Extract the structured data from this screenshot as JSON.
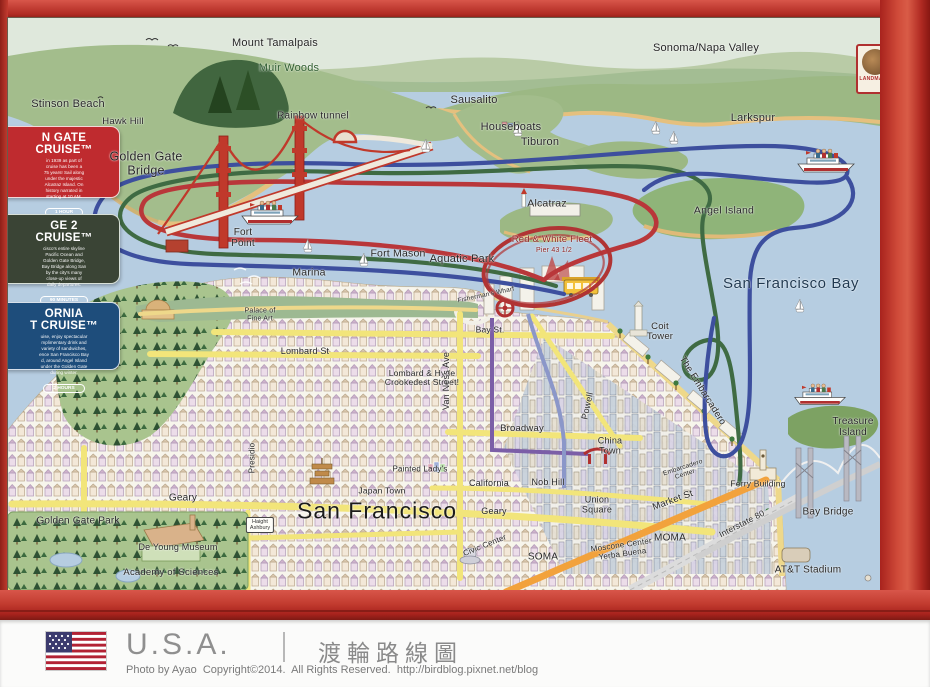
{
  "badge": {
    "text": "LANDMARK"
  },
  "colors": {
    "frame_red": "#bc2f2a",
    "water": "#b6cde1",
    "street_yellow": "#f2e57a",
    "market_orange": "#f2a23c",
    "route_red": "#b9373a",
    "route_green": "#3f6b43",
    "route_blue": "#3d4f9e",
    "annotation_circle": "#b03434"
  },
  "sidebar": {
    "cruises": [
      {
        "title_line1": "N GATE",
        "title_line2": "CRUISE™",
        "body": "in 1939 as part of\ncruise has been a\n75 years! Sail along\nunder the majestic\nAlcatraz Island. On\nhistory narrated in\nstarting at 10 AM.",
        "duration": "1 HOUR",
        "color": "#bf2b2f"
      },
      {
        "title_line1": "GE 2",
        "title_line2": "CRUISE™",
        "body": "cisco's entire skyline\nPacific Ocean and\nGolden Gate Bridge,\nBay Bridge along San\nby the city's many\nclose-up views of\ndaily departures.",
        "duration": "90 MINUTES",
        "color": "#3a4435"
      },
      {
        "title_line1": "ORNIA",
        "title_line2": "T CRUISE™",
        "body": "uise, enjoy spectacular\nmplimentary drink and\nvariety of sandwiches,\nence San Francisco Bay\nd, around Angel Island\nunder the Golden Gate\nduring winter.",
        "duration": "2 HOURS",
        "color": "#1e4d7b"
      }
    ]
  },
  "labels": {
    "mount_tamalpais": "Mount Tamalpais",
    "muir_woods": "Muir Woods",
    "sonoma_napa_valley": "Sonoma/Napa Valley",
    "stinson_beach": "Stinson Beach",
    "hawk_hill": "Hawk Hill",
    "rainbow_tunnel": "Rainbow tunnel",
    "sausalito": "Sausalito",
    "houseboats": "Houseboats",
    "tiburon": "Tiburon",
    "larkspur": "Larkspur",
    "golden_gate_bridge_1": "Golden Gate",
    "golden_gate_bridge_2": "Bridge",
    "fort_point_1": "Fort",
    "fort_point_2": "Point",
    "marina": "Marina",
    "fort_mason": "Fort Mason",
    "aquatic_park": "Aquatic Park",
    "alcatraz": "Alcatraz",
    "angel_island": "Angel Island",
    "red_white_fleet": "Red & White Fleet",
    "pier_43": "Pier 43 1/2",
    "san_francisco_bay": "San Francisco Bay",
    "fishermans_wharf": "Fisherman's Wharf",
    "coit_tower_1": "Coit",
    "coit_tower_2": "Tower",
    "bay_st": "Bay St.",
    "lombard_st": "Lombard St",
    "crookedest_1": "Lombard & Hyde",
    "crookedest_2": "Crookedest Street!",
    "van_ness_ave": "Van Ness Ave",
    "powell": "Powell",
    "broadway": "Broadway",
    "china_town_1": "China",
    "china_town_2": "Town",
    "the_embarcadero": "The Embarcadero",
    "treasure_island_1": "Treasure",
    "treasure_island_2": "Island",
    "nob_hill": "Nob Hill",
    "union_square_1": "Union",
    "union_square_2": "Square",
    "market_st": "Market St",
    "california_st": "California",
    "geary_downtown": "Geary",
    "japan_town": "Japan Town",
    "painted_ladys": "Painted Lady's",
    "san_francisco": "San Francisco",
    "geary_richmond": "Geary",
    "golden_gate_park": "Golden Gate Park",
    "de_young_museum": "De Young Museum",
    "academy_of_sciences": "Academy of Sciences",
    "haight_1": "Haight",
    "haight_2": "Ashbury",
    "presidio": "Presidio",
    "palace_1": "Palace of",
    "palace_2": "Fine Art",
    "soma": "SOMA",
    "moscone_1": "Moscone Center",
    "moscone_2": "Yerba Buena",
    "moma": "MOMA",
    "interstate_80": "Interstate 80",
    "civic_center": "Civic Center",
    "ferry_building": "Ferry Building",
    "bay_bridge": "Bay Bridge",
    "att_stadium": "AT&T Stadium",
    "embarcadero_center_1": "Embarcadero",
    "embarcadero_center_2": "Center"
  },
  "caption": {
    "country": "U.S.A.",
    "title_zh": "渡輪路線圖",
    "credit": "Photo by Ayao  Copyright©2014.  All Rights Reserved.  http://birdblog.pixnet.net/blog"
  }
}
